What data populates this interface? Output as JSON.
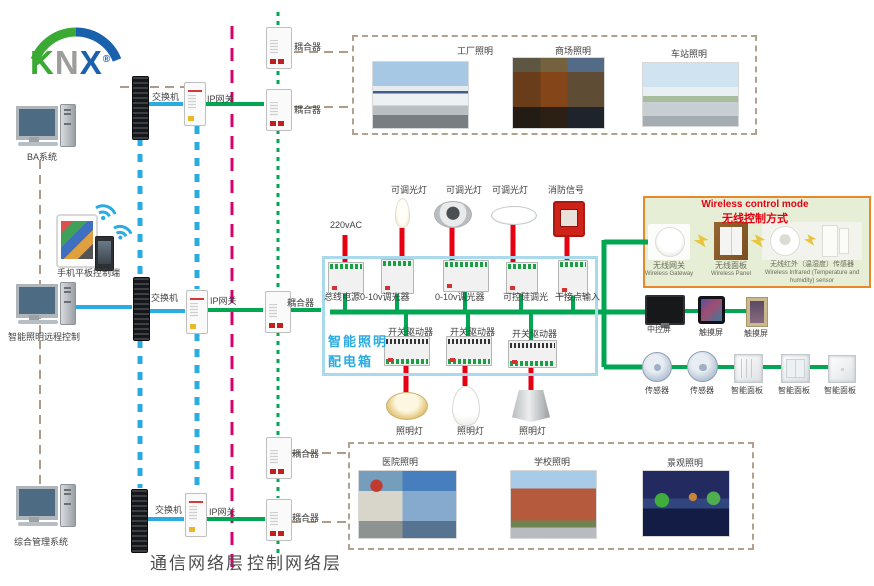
{
  "logo": {
    "text_k": "K",
    "text_n": "N",
    "text_x": "X",
    "reg": "®"
  },
  "computers": [
    {
      "label": "BA系统"
    },
    {
      "label": "智能照明远程控制"
    },
    {
      "label": "综合管理系统"
    }
  ],
  "mobile": {
    "label": "手机平板控制端"
  },
  "network": {
    "switches": [
      "交换机",
      "交换机",
      "交换机"
    ],
    "gateways": [
      "IP网关",
      "IP网关",
      "IP网关"
    ],
    "couplers": [
      "耦合器",
      "耦合器",
      "耦合器",
      "耦合器",
      "耦合器"
    ]
  },
  "layers": {
    "comm": "通信网络层",
    "ctrl": "控制网络层"
  },
  "top_apps": [
    {
      "label": "工厂照明"
    },
    {
      "label": "商场照明"
    },
    {
      "label": "车站照明"
    }
  ],
  "bottom_apps": [
    {
      "label": "医院照明"
    },
    {
      "label": "学校照明"
    },
    {
      "label": "景观照明"
    }
  ],
  "cabinet": {
    "title_line1": "智能照明",
    "title_line2": "配电箱",
    "power_label": "220vAC",
    "top_lamp_labels": [
      "可调光灯",
      "可调光灯",
      "可调光灯",
      "消防信号"
    ],
    "row1": [
      "总线电源",
      "0-10v调光器",
      "0-10v调光器",
      "可控硅调光",
      "干接点输入"
    ],
    "row2": [
      "开关驱动器",
      "开关驱动器",
      "开关驱动器"
    ],
    "bottom_lamp_labels": [
      "照明灯",
      "照明灯",
      "照明灯"
    ]
  },
  "wireless": {
    "title_en": "Wireless control mode",
    "title_zh": "无线控制方式",
    "items": [
      {
        "zh": "无线网关",
        "en": "Wireless Gateway"
      },
      {
        "zh": "无线面板",
        "en": "Wireless Panel"
      },
      {
        "zh": "无线红外（温湿度）传感器",
        "en": "Wireless Infrared (Temperature and humidity) sensor"
      }
    ]
  },
  "right_devices": {
    "screens": [
      {
        "label": "中控屏"
      },
      {
        "label": "触摸屏"
      },
      {
        "label": "触摸屏"
      }
    ],
    "sensors": [
      {
        "label": "传感器"
      },
      {
        "label": "传感器"
      }
    ],
    "panels": [
      {
        "label": "智能面板"
      },
      {
        "label": "智能面板"
      },
      {
        "label": "智能面板"
      }
    ]
  },
  "colors": {
    "bus_green": "#00a651",
    "lan_blue": "#2aabe2",
    "layer_magenta": "#d6006f",
    "link_tan": "#ab9d8a",
    "lamp_red": "#e60012",
    "cabinet_border": "#a9d9ea",
    "cabinet_text": "#29abe2",
    "wireless_border": "#e8882b",
    "wireless_bg": "#e6eed6",
    "wireless_title": "#e60012",
    "knx_green": "#3aaa35",
    "knx_gray": "#9d9d9c",
    "knx_blue": "#1961ac"
  }
}
